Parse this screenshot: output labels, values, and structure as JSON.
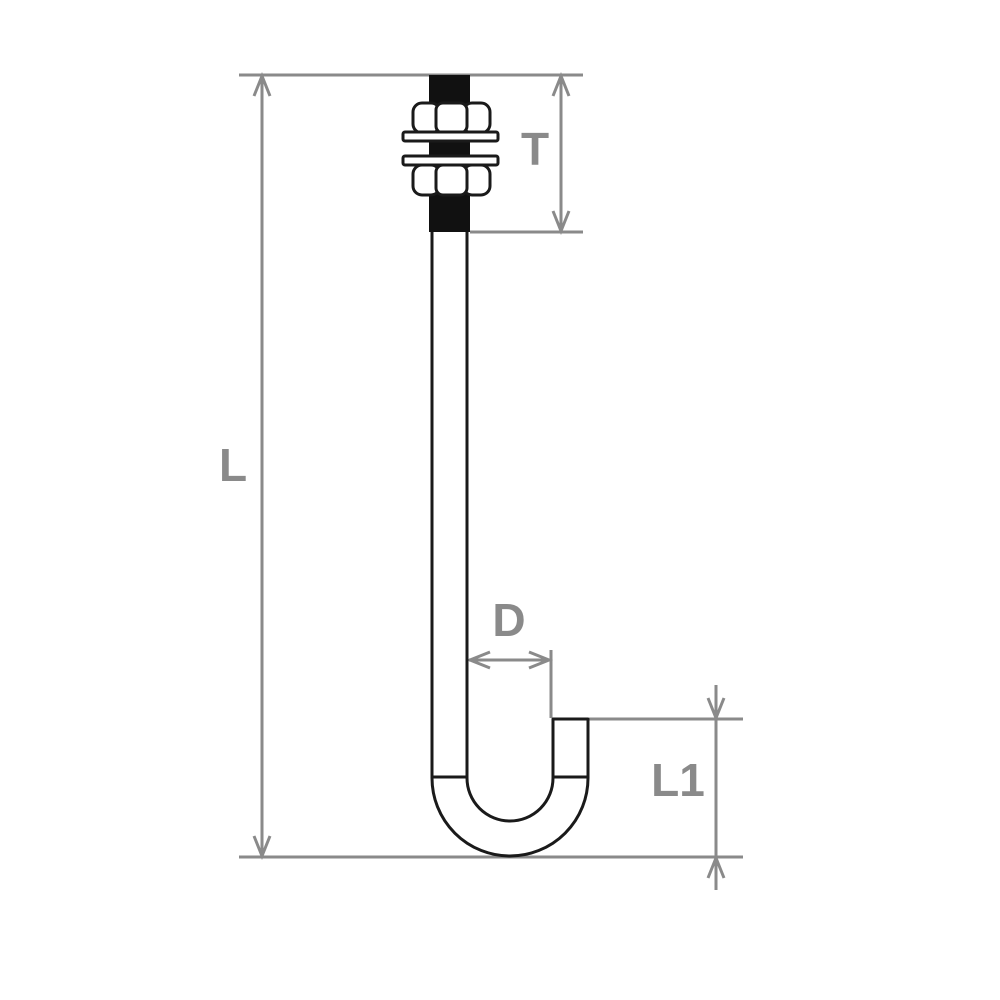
{
  "drawing": {
    "description": "Technical line drawing of a J-bolt anchor with two hex nuts and two washers on the threaded end",
    "view": "side elevation"
  },
  "labels": {
    "overall_length": "L",
    "thread_length": "T",
    "bend_diameter": "D",
    "hook_length": "L1"
  },
  "colors": {
    "outline": "#1a1a1a",
    "solid_fill": "#111111",
    "dimension": "#8a8a8a",
    "background": "#ffffff"
  }
}
